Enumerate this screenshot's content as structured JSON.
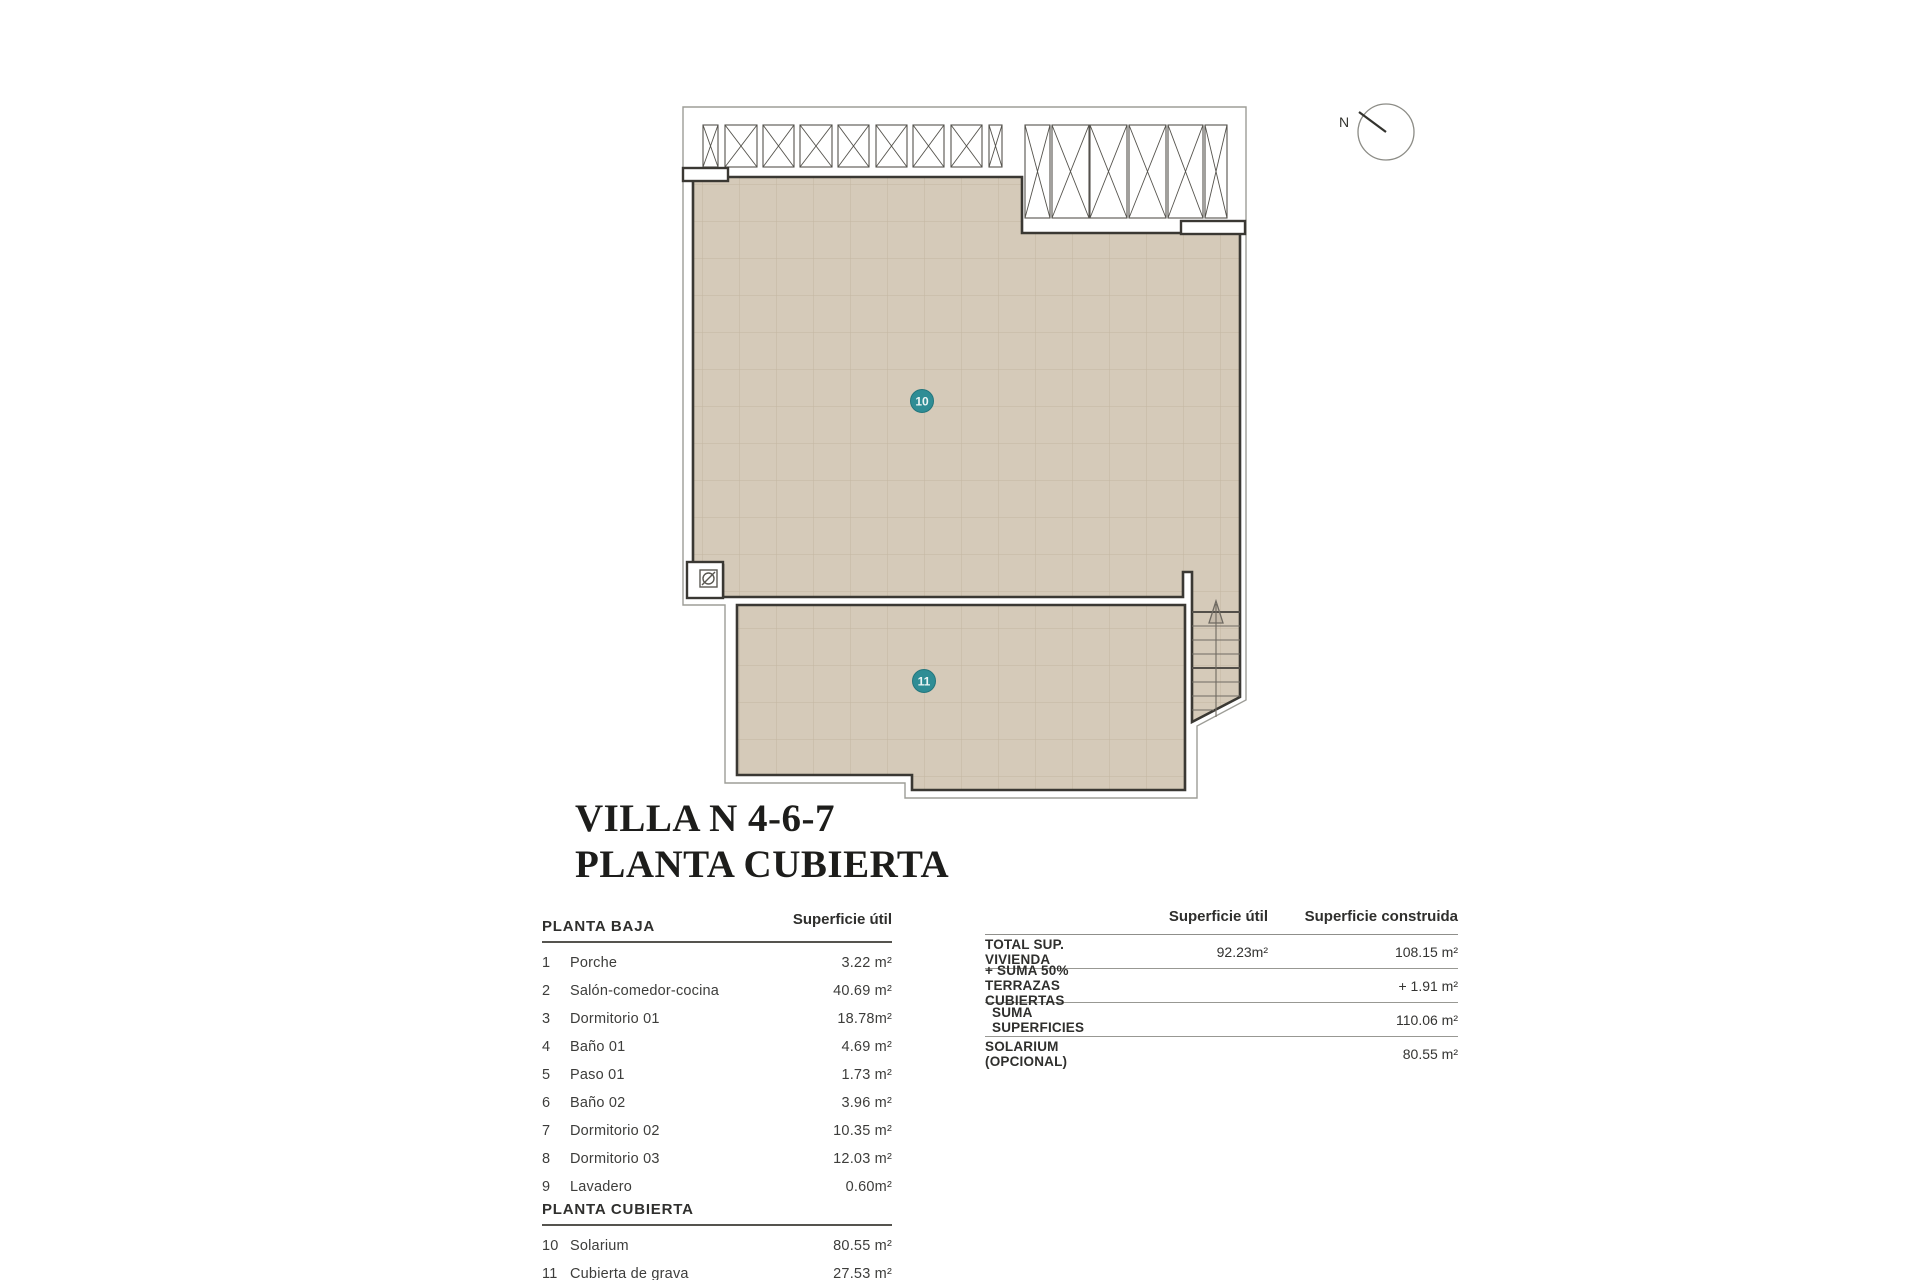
{
  "title": {
    "line1": "VILLA N 4-6-7",
    "line2": "PLANTA CUBIERTA"
  },
  "plan": {
    "marker_10": "10",
    "marker_11": "11",
    "compass_label": "N"
  },
  "left_table": {
    "sections": [
      {
        "header": "PLANTA BAJA",
        "header_right": "Superficie útil",
        "rows": [
          {
            "num": "1",
            "name": "Porche",
            "value": "3.22 m²"
          },
          {
            "num": "2",
            "name": "Salón-comedor-cocina",
            "value": "40.69 m²"
          },
          {
            "num": "3",
            "name": "Dormitorio 01",
            "value": "18.78m²"
          },
          {
            "num": "4",
            "name": "Baño 01",
            "value": "4.69 m²"
          },
          {
            "num": "5",
            "name": "Paso 01",
            "value": "1.73 m²"
          },
          {
            "num": "6",
            "name": "Baño 02",
            "value": "3.96 m²"
          },
          {
            "num": "7",
            "name": "Dormitorio 02",
            "value": "10.35 m²"
          },
          {
            "num": "8",
            "name": "Dormitorio 03",
            "value": "12.03 m²"
          },
          {
            "num": "9",
            "name": "Lavadero",
            "value": "0.60m²"
          }
        ]
      },
      {
        "header": "PLANTA CUBIERTA",
        "header_right": "",
        "rows": [
          {
            "num": "10",
            "name": "Solarium",
            "value": "80.55 m²"
          },
          {
            "num": "11",
            "name": "Cubierta de grava",
            "value": "27.53 m²"
          }
        ]
      }
    ]
  },
  "right_table": {
    "col1_header": "Superficie útil",
    "col2_header": "Superficie construida",
    "rows": [
      {
        "label": "TOTAL SUP. VIVIENDA",
        "util": "92.23m²",
        "construida": "108.15 m²",
        "underline": true
      },
      {
        "label": "+ SUMA 50% TERRAZAS CUBIERTAS",
        "util": "",
        "construida": "+ 1.91 m²",
        "underline": true
      },
      {
        "label": "SUMA SUPERFICIES",
        "util": "",
        "construida": "110.06 m²",
        "underline": true
      },
      {
        "label": "SOLARIUM (OPCIONAL)",
        "util": "",
        "construida": "80.55 m²",
        "underline": false
      }
    ]
  },
  "colors": {
    "tan": "#d5cab9",
    "teal": "#2f8d95",
    "wall": "#3a3833",
    "outline": "#9d9d97"
  }
}
